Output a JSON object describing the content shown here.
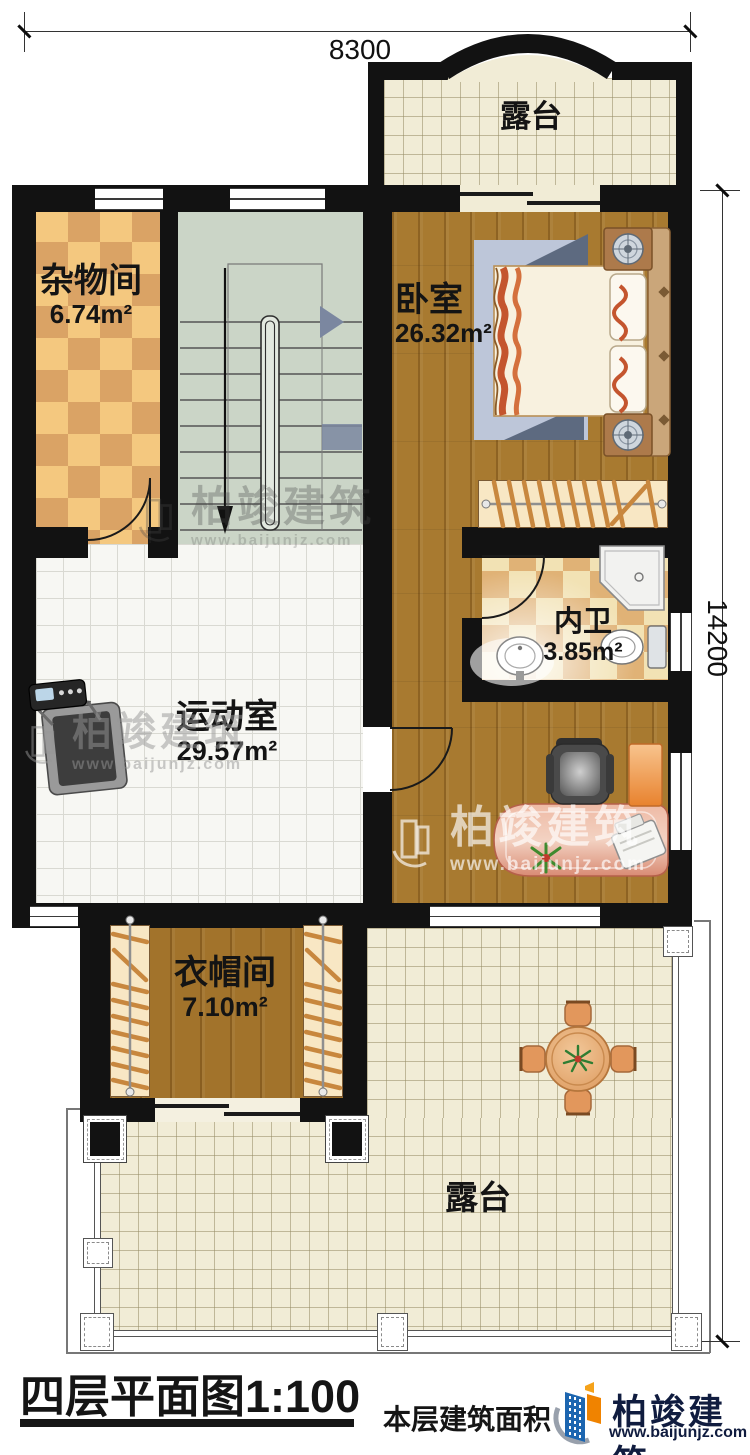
{
  "dimensions": {
    "width_label": "8300",
    "height_label": "14200"
  },
  "rooms": {
    "terrace_top": {
      "name": "露台"
    },
    "storage": {
      "name": "杂物间",
      "area": "6.74m²"
    },
    "bedroom": {
      "name": "卧室",
      "area": "26.32m²"
    },
    "bathroom": {
      "name": "内卫",
      "area": "3.85m²"
    },
    "gym": {
      "name": "运动室",
      "area": "29.57m²"
    },
    "cloakroom": {
      "name": "衣帽间",
      "area": "7.10m²"
    },
    "terrace_bottom": {
      "name": "露台"
    }
  },
  "title_block": {
    "title": "四层平面图1:100",
    "area_note": "本层建筑面积"
  },
  "branding": {
    "company": "柏竣建筑",
    "website": "www.baijunjz.com"
  },
  "watermark": {
    "company": "柏竣建筑",
    "website": "www.baijunjz.com"
  },
  "colors": {
    "wall": "#121212",
    "wood": "#a87a30",
    "terrace_floor": "#f1ecd6",
    "stair_floor": "#cbd5c7",
    "gym_tile": "#f7f7f3",
    "storage_checker_light": "#f4c87f",
    "storage_checker_dark": "#daa365",
    "bath_checker_light": "#f2e2b4",
    "bath_checker_dark": "#e0b276",
    "brand_blue": "#1d66b0",
    "brand_orange": "#f08300",
    "desk": "#e2967e"
  }
}
